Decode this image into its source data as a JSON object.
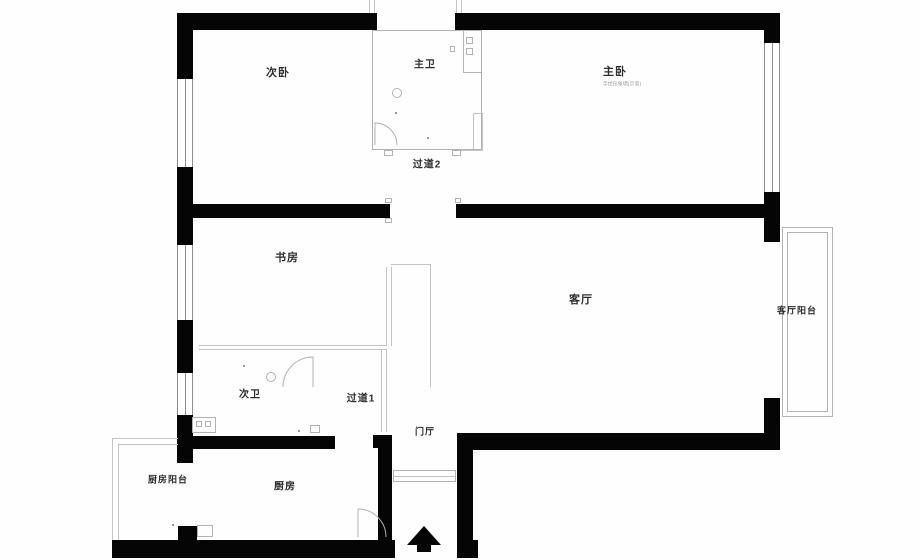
{
  "plan": {
    "title": "apartment-floorplan",
    "colors": {
      "wall": "#050505",
      "thin": "#b2b2b2",
      "window": "#8f8f8f",
      "label": "#2e2e2e",
      "note": "#a0a0a0",
      "background": "#fefefe"
    },
    "rooms": [
      {
        "id": "secondary-bedroom",
        "label": "次卧",
        "x": 278,
        "y": 72,
        "size": 11
      },
      {
        "id": "master-bath",
        "label": "主卫",
        "x": 425,
        "y": 63,
        "size": 10
      },
      {
        "id": "master-bedroom",
        "label": "主卧",
        "x": 615,
        "y": 71,
        "size": 11
      },
      {
        "id": "master-bedroom-note",
        "label": "手绘形象墙(示意)",
        "x": 622,
        "y": 84,
        "size": 5,
        "color": "#a0a0a0",
        "weight": 400,
        "spacing": "0px"
      },
      {
        "id": "corridor-2",
        "label": "过道2",
        "x": 427,
        "y": 163,
        "size": 10
      },
      {
        "id": "study",
        "label": "书房",
        "x": 287,
        "y": 257,
        "size": 11
      },
      {
        "id": "living-room",
        "label": "客厅",
        "x": 581,
        "y": 299,
        "size": 11
      },
      {
        "id": "living-room-balcony",
        "label": "客厅阳台",
        "x": 797,
        "y": 310,
        "size": 9
      },
      {
        "id": "secondary-bath",
        "label": "次卫",
        "x": 250,
        "y": 393,
        "size": 10
      },
      {
        "id": "corridor-1",
        "label": "过道1",
        "x": 361,
        "y": 397,
        "size": 10
      },
      {
        "id": "foyer",
        "label": "门厅",
        "x": 425,
        "y": 431,
        "size": 9
      },
      {
        "id": "kitchen-balcony",
        "label": "厨房阳台",
        "x": 168,
        "y": 479,
        "size": 9
      },
      {
        "id": "kitchen",
        "label": "厨房",
        "x": 285,
        "y": 485,
        "size": 10
      }
    ],
    "walls": [
      {
        "id": "top-left",
        "x": 177,
        "y": 13,
        "w": 200,
        "h": 17
      },
      {
        "id": "top-right",
        "x": 455,
        "y": 13,
        "w": 325,
        "h": 17
      },
      {
        "id": "left-1",
        "x": 177,
        "y": 13,
        "w": 16,
        "h": 66
      },
      {
        "id": "left-2",
        "x": 177,
        "y": 167,
        "w": 16,
        "h": 78
      },
      {
        "id": "left-3",
        "x": 177,
        "y": 320,
        "w": 16,
        "h": 53
      },
      {
        "id": "left-4",
        "x": 177,
        "y": 415,
        "w": 16,
        "h": 48
      },
      {
        "id": "right-1",
        "x": 764,
        "y": 13,
        "w": 16,
        "h": 30
      },
      {
        "id": "right-2",
        "x": 764,
        "y": 192,
        "w": 16,
        "h": 50
      },
      {
        "id": "right-3",
        "x": 764,
        "y": 398,
        "w": 16,
        "h": 52
      },
      {
        "id": "mid-left",
        "x": 193,
        "y": 204,
        "w": 197,
        "h": 14
      },
      {
        "id": "mid-right",
        "x": 456,
        "y": 204,
        "w": 324,
        "h": 14
      },
      {
        "id": "lower-left",
        "x": 178,
        "y": 436,
        "w": 157,
        "h": 13
      },
      {
        "id": "kitchen-top",
        "x": 373,
        "y": 435,
        "w": 19,
        "h": 13
      },
      {
        "id": "kitchen-right",
        "x": 378,
        "y": 448,
        "w": 14,
        "h": 110
      },
      {
        "id": "foyer-right",
        "x": 457,
        "y": 433,
        "w": 16,
        "h": 125
      },
      {
        "id": "living-bottom",
        "x": 457,
        "y": 433,
        "w": 323,
        "h": 17
      },
      {
        "id": "bottom-left",
        "x": 112,
        "y": 540,
        "w": 283,
        "h": 18
      },
      {
        "id": "bottom-right",
        "x": 457,
        "y": 540,
        "w": 21,
        "h": 18
      },
      {
        "id": "kitchen-stub",
        "x": 178,
        "y": 526,
        "w": 19,
        "h": 16
      }
    ],
    "windows": [
      {
        "id": "left-top",
        "x": 177,
        "y": 79,
        "w": 16,
        "h": 88,
        "o": "v"
      },
      {
        "id": "left-mid",
        "x": 177,
        "y": 245,
        "w": 16,
        "h": 75,
        "o": "v"
      },
      {
        "id": "left-low",
        "x": 177,
        "y": 373,
        "w": 16,
        "h": 42,
        "o": "v"
      },
      {
        "id": "right-main",
        "x": 764,
        "y": 43,
        "w": 16,
        "h": 149,
        "o": "v"
      }
    ],
    "lines": [
      {
        "id": "study-divider-a",
        "x": 199,
        "y": 345,
        "w": 188,
        "h": 1
      },
      {
        "id": "study-divider-b",
        "x": 199,
        "y": 349,
        "w": 188,
        "h": 1
      },
      {
        "id": "study-right-a",
        "x": 386,
        "y": 267,
        "w": 1,
        "h": 79
      },
      {
        "id": "study-right-b",
        "x": 391,
        "y": 267,
        "w": 1,
        "h": 79
      },
      {
        "id": "hall-top",
        "x": 391,
        "y": 264,
        "w": 40,
        "h": 1
      },
      {
        "id": "hall-right",
        "x": 430,
        "y": 264,
        "w": 1,
        "h": 123
      },
      {
        "id": "bath2-right-a",
        "x": 381,
        "y": 350,
        "w": 1,
        "h": 82
      },
      {
        "id": "bath2-right-b",
        "x": 386,
        "y": 350,
        "w": 1,
        "h": 82
      },
      {
        "id": "kb-left-outer",
        "x": 112,
        "y": 438,
        "w": 1,
        "h": 102
      },
      {
        "id": "kb-top-outer",
        "x": 112,
        "y": 438,
        "w": 66,
        "h": 1
      },
      {
        "id": "kb-left-inner",
        "x": 118,
        "y": 444,
        "w": 1,
        "h": 96
      },
      {
        "id": "kb-top-inner",
        "x": 118,
        "y": 444,
        "w": 60,
        "h": 1
      },
      {
        "id": "threshold-mid",
        "x": 394,
        "y": 476,
        "w": 62,
        "h": 1
      },
      {
        "id": "bath-step-v",
        "x": 473,
        "y": 113,
        "w": 1,
        "h": 37
      },
      {
        "id": "bath-step-h",
        "x": 473,
        "y": 113,
        "w": 9,
        "h": 1
      },
      {
        "id": "mbr-line-v",
        "x": 482,
        "y": 113,
        "w": 1,
        "h": 38
      },
      {
        "id": "mbr-line-h",
        "x": 452,
        "y": 150,
        "w": 31,
        "h": 1
      },
      {
        "id": "shaft-left-a",
        "x": 369,
        "y": 0,
        "w": 1,
        "h": 13
      },
      {
        "id": "shaft-left-b",
        "x": 374,
        "y": 0,
        "w": 1,
        "h": 13
      },
      {
        "id": "shaft-right-a",
        "x": 456,
        "y": 0,
        "w": 1,
        "h": 13
      },
      {
        "id": "shaft-right-b",
        "x": 461,
        "y": 0,
        "w": 1,
        "h": 13
      }
    ],
    "boxes": [
      {
        "id": "master-bath-outline",
        "x": 372,
        "y": 30,
        "w": 110,
        "h": 120
      },
      {
        "id": "bath-tab-left",
        "x": 384,
        "y": 150,
        "w": 9,
        "h": 6
      },
      {
        "id": "bath-tab-right",
        "x": 452,
        "y": 150,
        "w": 9,
        "h": 6
      },
      {
        "id": "pipe-shaft-box",
        "x": 463,
        "y": 30,
        "w": 19,
        "h": 43
      },
      {
        "id": "pipe-shaft-sq-1",
        "x": 466,
        "y": 37,
        "w": 7,
        "h": 7
      },
      {
        "id": "pipe-shaft-sq-2",
        "x": 466,
        "y": 48,
        "w": 7,
        "h": 7
      },
      {
        "id": "basin-box",
        "x": 192,
        "y": 417,
        "w": 24,
        "h": 16
      },
      {
        "id": "basin-sq-1",
        "x": 196,
        "y": 421,
        "w": 6,
        "h": 6
      },
      {
        "id": "basin-sq-2",
        "x": 205,
        "y": 421,
        "w": 6,
        "h": 6
      },
      {
        "id": "bath2-small-box",
        "x": 310,
        "y": 425,
        "w": 10,
        "h": 8
      },
      {
        "id": "kitchen-sink",
        "x": 197,
        "y": 525,
        "w": 16,
        "h": 12
      },
      {
        "id": "entry-threshold",
        "x": 393,
        "y": 470,
        "w": 63,
        "h": 12
      },
      {
        "id": "jamb-mark-1",
        "x": 385,
        "y": 198,
        "w": 7,
        "h": 5
      },
      {
        "id": "jamb-mark-2",
        "x": 385,
        "y": 218,
        "w": 7,
        "h": 5
      },
      {
        "id": "jamb-mark-3",
        "x": 455,
        "y": 198,
        "w": 6,
        "h": 5
      },
      {
        "id": "mbr-wall-mark",
        "x": 450,
        "y": 46,
        "w": 5,
        "h": 6
      },
      {
        "id": "living-balcony-outer",
        "x": 782,
        "y": 227,
        "w": 51,
        "h": 190
      },
      {
        "id": "living-balcony-inner",
        "x": 787,
        "y": 232,
        "w": 41,
        "h": 180
      }
    ],
    "dots": [
      {
        "id": "dot-1",
        "x": 427,
        "y": 137
      },
      {
        "id": "dot-2",
        "x": 395,
        "y": 112
      },
      {
        "id": "dot-3",
        "x": 243,
        "y": 365
      },
      {
        "id": "dot-4",
        "x": 298,
        "y": 430
      },
      {
        "id": "dot-5",
        "x": 172,
        "y": 524
      }
    ],
    "circles": [
      {
        "id": "drain-master-bath",
        "cx": 397,
        "cy": 93,
        "r": 4.5
      },
      {
        "id": "drain-secondary-bath",
        "cx": 271,
        "cy": 377,
        "r": 4.5
      }
    ],
    "paths": [
      {
        "id": "master-bath-door-arc",
        "d": "M375 145 L375 123 A22 22 0 0 1 397 145"
      },
      {
        "id": "secondary-bath-door-arc",
        "d": "M313 387 L313 357 A30 30 0 0 0 283 387"
      },
      {
        "id": "kitchen-door-arc",
        "d": "M358 537 L358 509 A28 28 0 0 1 386 537"
      },
      {
        "id": "entry-arrow-head",
        "d": "M424 526 L407 545 L441 545 Z",
        "fill": "#050505"
      },
      {
        "id": "entry-arrow-stem",
        "d": "M417 545 L431 545 L431 552 L417 552 Z",
        "fill": "#050505"
      }
    ]
  }
}
